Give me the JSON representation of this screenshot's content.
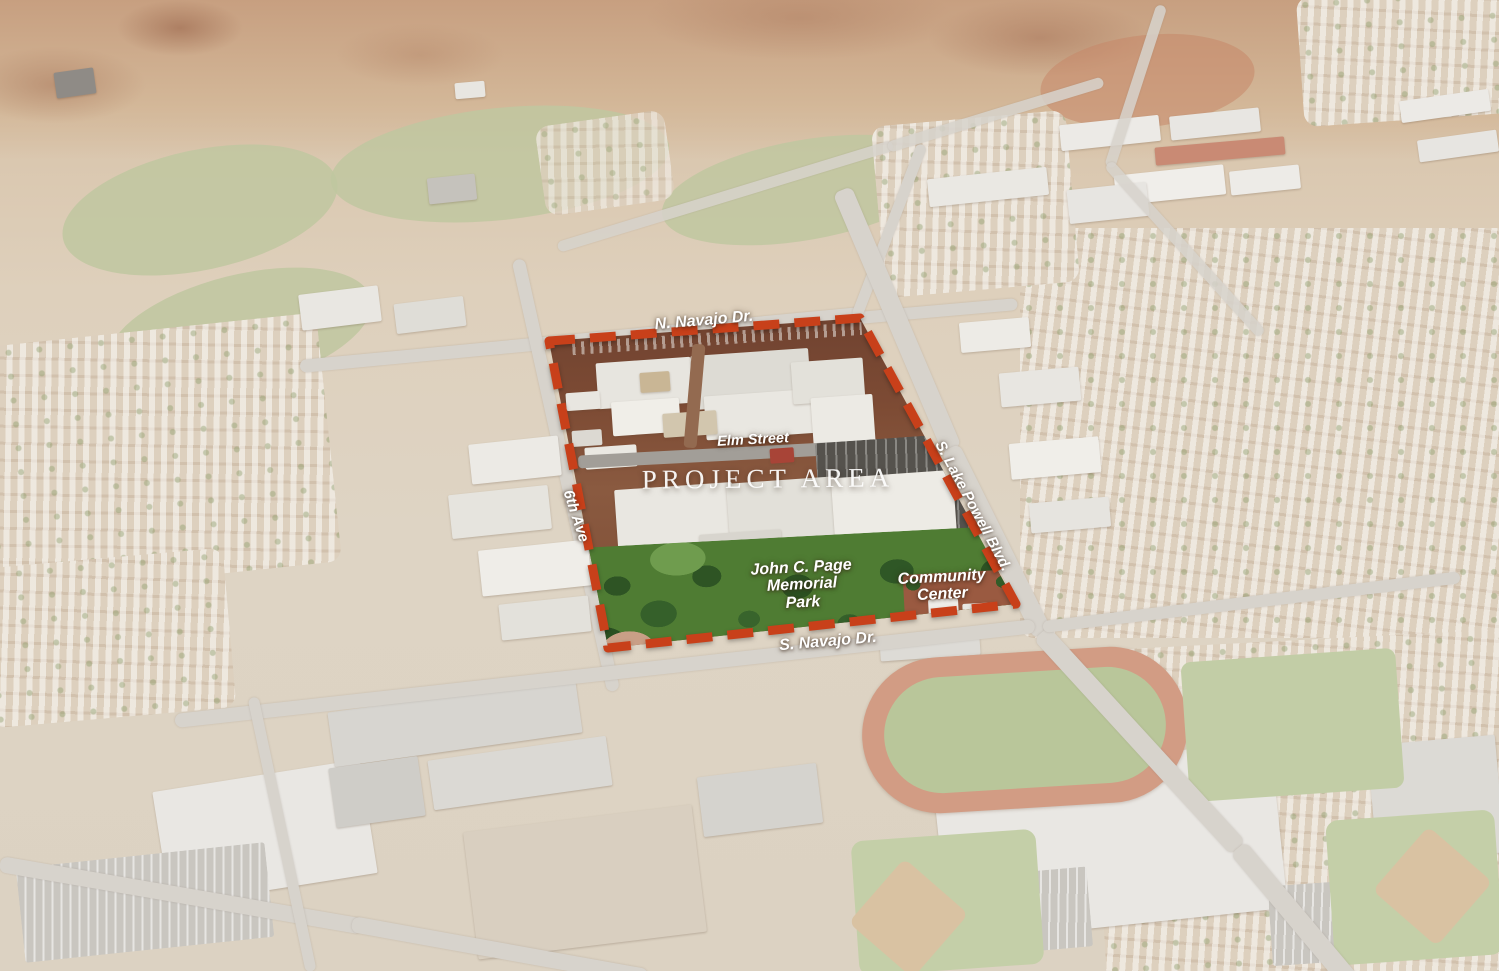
{
  "map": {
    "labels": {
      "project_area": "PROJECT AREA",
      "n_navajo_dr": "N. Navajo Dr.",
      "elm_street": "Elm Street",
      "sixth_ave": "6th Ave",
      "s_lake_powell_blvd": "S. Lake Powell Blvd.",
      "john_c_page_memorial_park": {
        "line1": "John C. Page",
        "line2": "Memorial",
        "line3": "Park"
      },
      "community_center": {
        "line1": "Community",
        "line2": "Center"
      },
      "s_navajo_dr": "S. Navajo Dr."
    },
    "colors": {
      "boundary_dash": "#c8401a",
      "label_text": "#ffffff",
      "park_green": "#4f7c33",
      "parking_brown": "#7b4a33",
      "asphalt_gray": "#55524d",
      "roof_white": "#e9e7e1",
      "desert_base": "#d9cbb8",
      "golf_green": "#bfc7a0",
      "track_red": "#d29c84",
      "plaza_brick": "#9a5a41"
    }
  }
}
